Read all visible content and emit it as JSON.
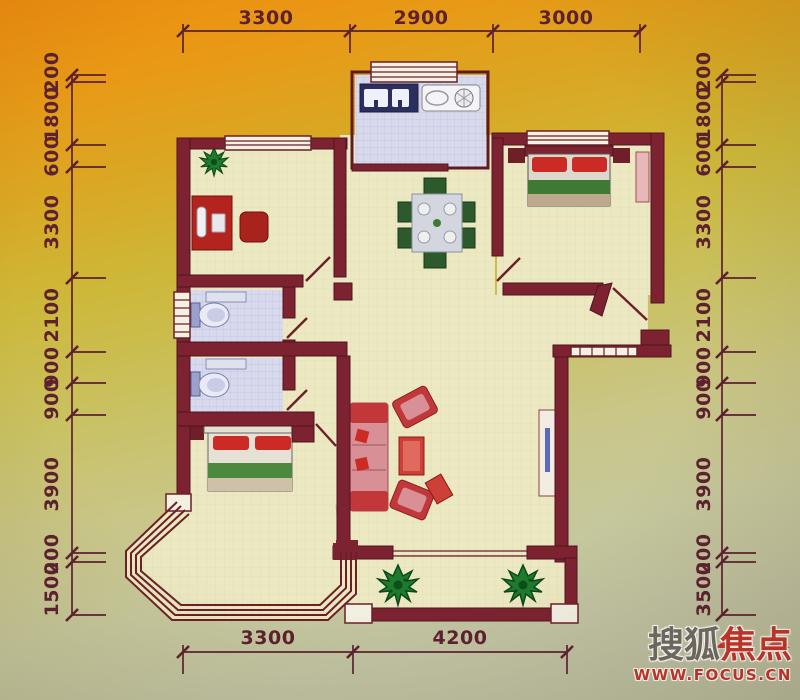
{
  "dimensions": {
    "top": [
      "3300",
      "2900",
      "3000"
    ],
    "bottom": [
      "3300",
      "4200"
    ],
    "left": [
      "200",
      "1800",
      "600",
      "3300",
      "2100",
      "900",
      "900",
      "3900",
      "200",
      "1500"
    ],
    "right": [
      "200",
      "1800",
      "600",
      "3300",
      "2100",
      "900",
      "900",
      "3900",
      "200",
      "3500"
    ]
  },
  "logo": {
    "brand_gray": "搜狐",
    "brand_red": "焦点",
    "url": "WWW.FOCUS.CN"
  },
  "colors": {
    "wall": "#7c2230",
    "dim_line": "#5d2130",
    "floor": "#ebe8c2",
    "tile": "#d8d9ec",
    "accent_red": "#cc2b25",
    "accent_green": "#3f7a35",
    "sofa_pink": "#d98f96",
    "logo_red": "#c5352b",
    "logo_gray": "#6f6c64",
    "bg_orange": "#ef8d10",
    "bg_olive": "#c9c05c",
    "bg_sage": "#bfc2a2"
  }
}
